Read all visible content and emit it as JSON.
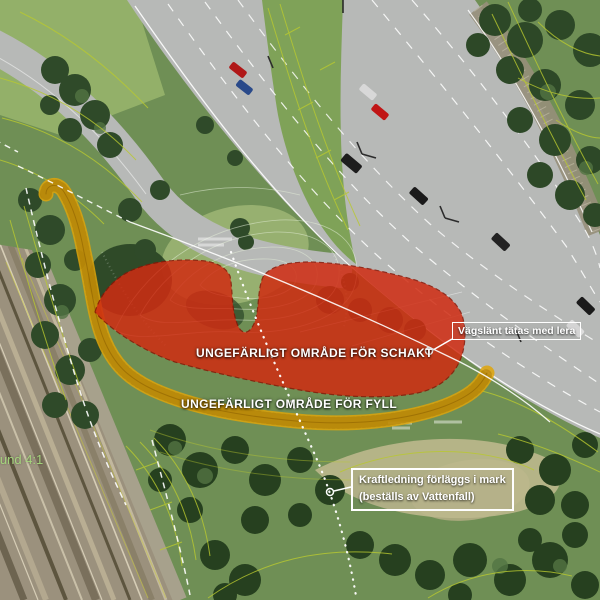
{
  "overlay_labels": {
    "schakt": "UNGEFÄRLIGT OMRÅDE FÖR SCHAKT",
    "fyll": "UNGEFÄRLIGT OMRÅDE FÖR FYLL"
  },
  "callouts": {
    "vagslant": "Vägslänt tätas med lera",
    "kraftledning_line1": "Kraftledning förläggs i mark",
    "kraftledning_line2": "(beställs av Vattenfall)"
  },
  "parcel_label": "lund 4:1",
  "colors": {
    "schakt_area": "#d02c12",
    "fyll_area": "#dfa50a",
    "survey_contour": "#b9c92f",
    "boundary_line": "#ffffff",
    "label_text": "#ffffff"
  }
}
